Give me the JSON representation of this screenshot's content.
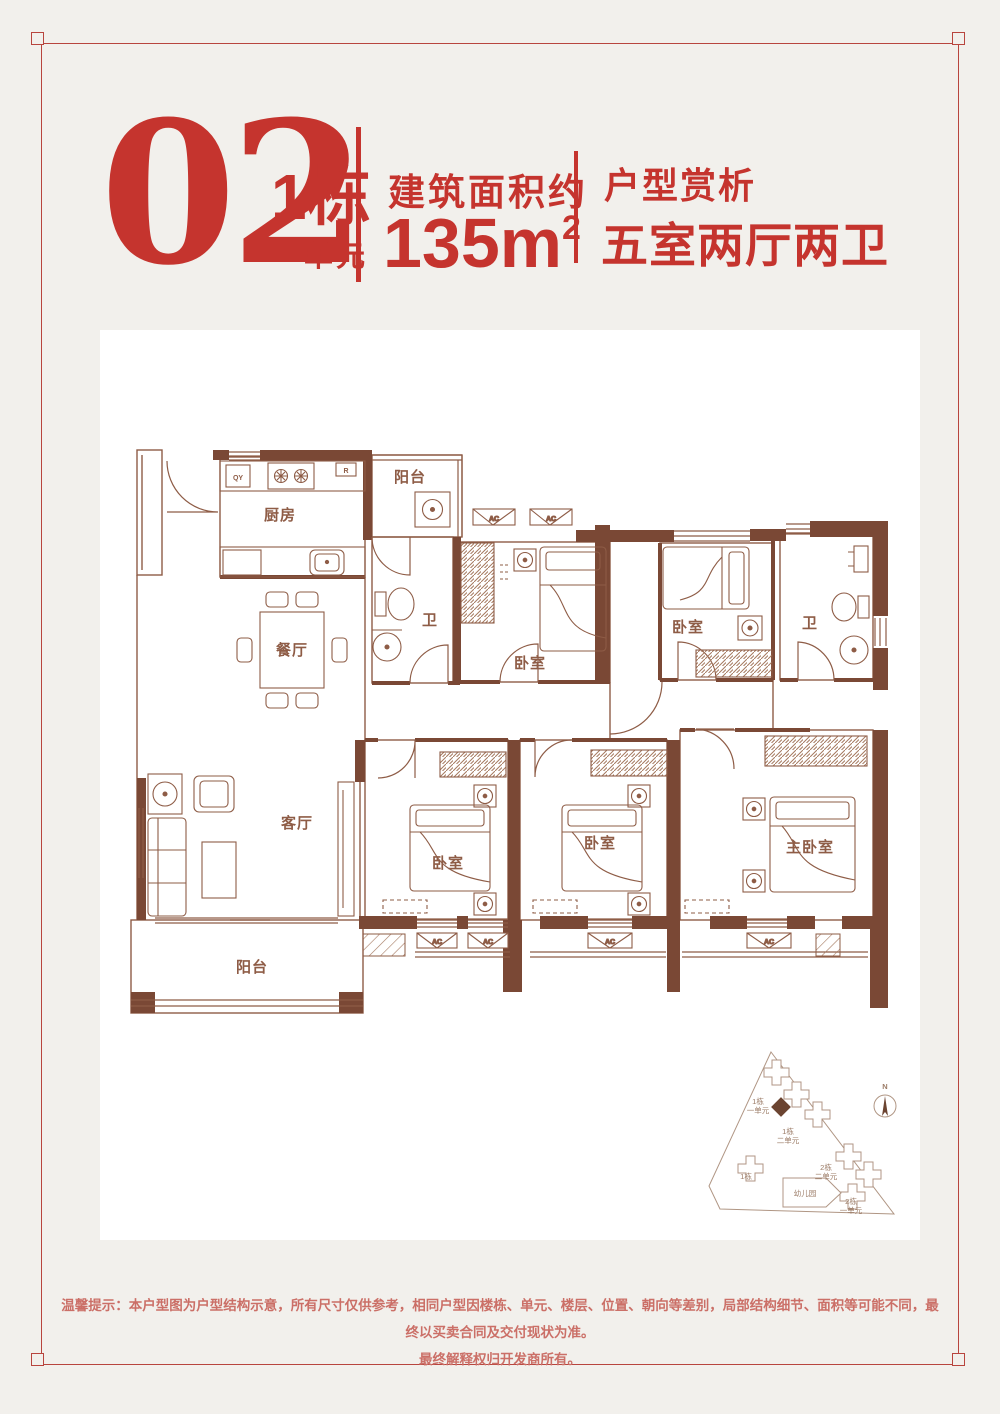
{
  "colors": {
    "background": "#f2f0ec",
    "card": "#ffffff",
    "accent": "#c5342e",
    "frame": "#b8453e",
    "plan_dark": "#7a4835",
    "plan_mid": "#8e5c46",
    "plan_light": "#a57a60",
    "disclaimer": "#cb6f67"
  },
  "header": {
    "number": "02",
    "building": "1栋",
    "unit": "一单元",
    "area_label": "建筑面积约",
    "area_value": "135m",
    "area_sup": "2",
    "review_label": "户型赏析",
    "layout_desc": "五室两厅两卫"
  },
  "floorplan": {
    "labels": {
      "kitchen": "厨房",
      "dining": "餐厅",
      "living": "客厅",
      "balcony_top": "阳台",
      "balcony_bottom": "阳台",
      "bath_left": "卫",
      "bath_right": "卫",
      "bedroom_top_mid": "卧室",
      "bedroom_top_right": "卧室",
      "bedroom_bottom_1": "卧室",
      "bedroom_bottom_2": "卧室",
      "master_bedroom": "主卧室",
      "tag_qy": "QY",
      "tag_r": "R",
      "tag_ac": "AC"
    }
  },
  "sitemap": {
    "b1u1_line1": "1栋",
    "b1u1_line2": "一单元",
    "b1u2_line1": "1栋",
    "b1u2_line2": "二单元",
    "b1": "1栋",
    "b2u2_line1": "2栋",
    "b2u2_line2": "二单元",
    "kindergarten": "幼儿园",
    "b2u1_line1": "2栋",
    "b2u1_line2": "一单元",
    "north": "N"
  },
  "disclaimer": {
    "line1": "温馨提示：本户型图为户型结构示意，所有尺寸仅供参考，相同户型因楼栋、单元、楼层、位置、朝向等差别，局部结构细节、面积等可能不同，最终以买卖合同及交付现状为准。",
    "line2": "最终解释权归开发商所有。"
  }
}
